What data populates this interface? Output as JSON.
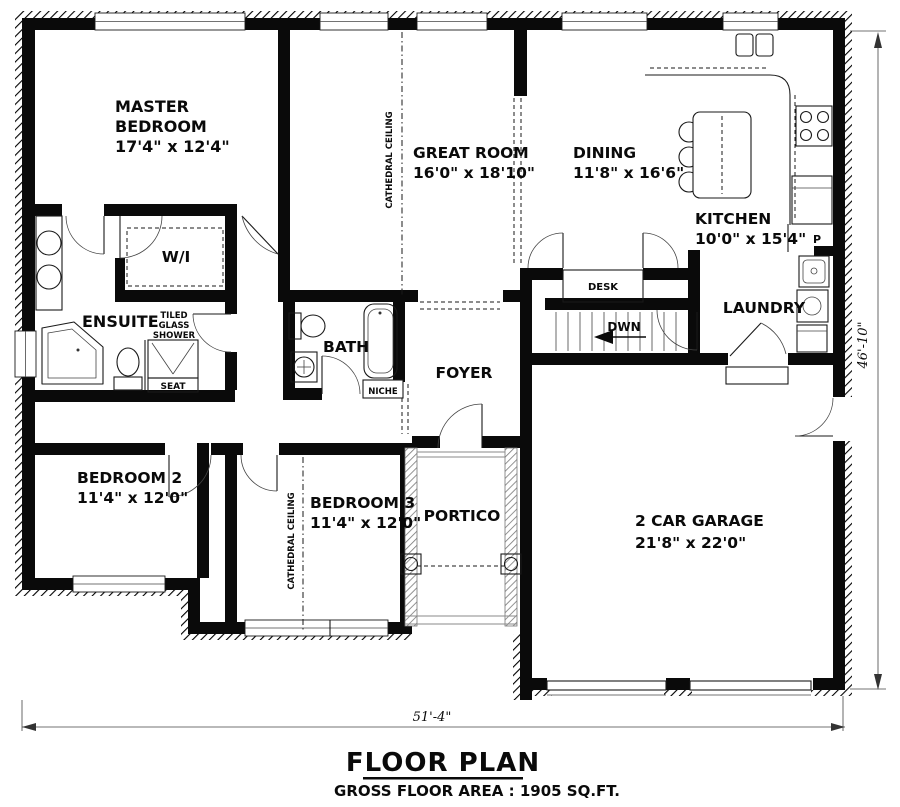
{
  "floor_plan": {
    "title": "FLOOR PLAN",
    "subtitle": "GROSS FLOOR AREA : 1905 SQ.FT.",
    "overall_width": "51'-4\"",
    "overall_depth": "46'-10\"",
    "rooms": {
      "master_bedroom": {
        "name_line1": "MASTER",
        "name_line2": "BEDROOM",
        "dims": "17'4\" x 12'4\""
      },
      "great_room": {
        "name": "GREAT ROOM",
        "dims": "16'0\" x 18'10\""
      },
      "dining": {
        "name": "DINING",
        "dims": "11'8\" x 16'6\""
      },
      "kitchen": {
        "name": "KITCHEN",
        "dims": "10'0\" x 15'4\""
      },
      "bedroom2": {
        "name": "BEDROOM 2",
        "dims": "11'4\" x 12'0\""
      },
      "bedroom3": {
        "name": "BEDROOM 3",
        "dims": "11'4\" x 12'0\""
      },
      "garage": {
        "name": "2 CAR GARAGE",
        "dims": "21'8\" x 22'0\""
      },
      "ensuite": {
        "name": "ENSUITE"
      },
      "walk_in_closet": {
        "name": "W/I"
      },
      "bath": {
        "name": "BATH"
      },
      "foyer": {
        "name": "FOYER"
      },
      "laundry": {
        "name": "LAUNDRY"
      },
      "portico": {
        "name": "PORTICO"
      }
    },
    "annotations": {
      "tiled_shower_line1": "TILED",
      "tiled_shower_line2": "GLASS",
      "tiled_shower_line3": "SHOWER",
      "seat": "SEAT",
      "niche": "NICHE",
      "desk": "DESK",
      "stairs_down": "DWN",
      "pantry": "P",
      "cathedral_ceiling": "CATHEDRAL CEILING"
    }
  }
}
